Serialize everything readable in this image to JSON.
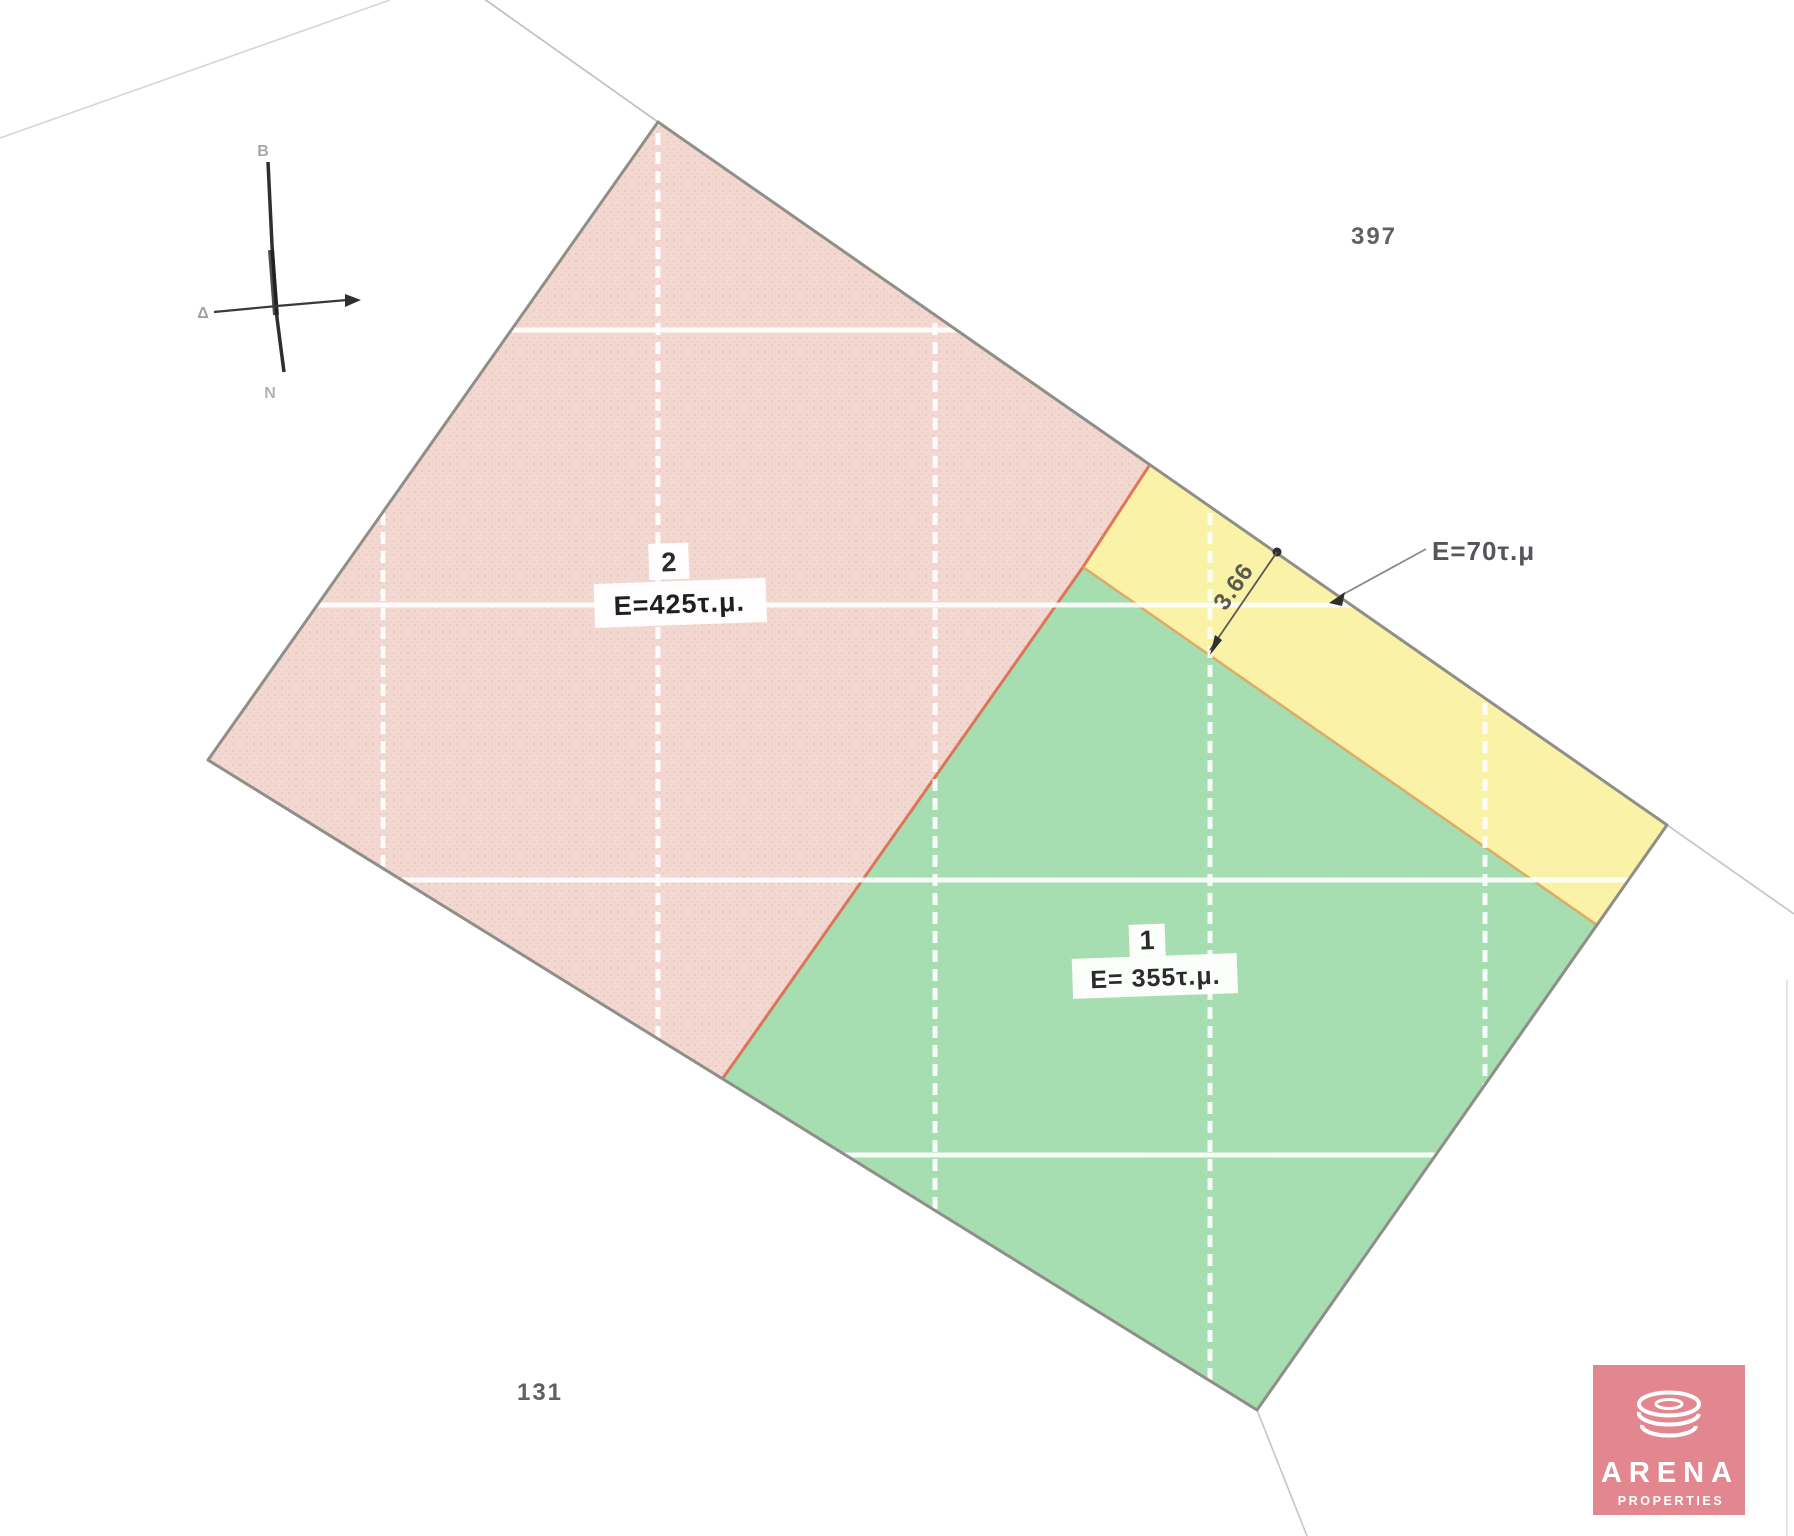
{
  "plan": {
    "plot2": {
      "number": "2",
      "area_label": "E=425τ.μ."
    },
    "plot1": {
      "number": "1",
      "area_label": "E= 355τ.μ."
    },
    "strip": {
      "area_label": "E=70τ.μ",
      "width_label": "3.66"
    },
    "adjacent_parcels": {
      "north_east": "397",
      "south_west": "131"
    }
  },
  "compass": {
    "north_label": "B",
    "west_label": "Δ",
    "south_label": "N"
  },
  "logo": {
    "brand": "ARENA",
    "tagline": "PROPERTIES"
  },
  "colors": {
    "plot2_pink": "#f3d8d1",
    "plot2_dot": "#d9a89e",
    "plot1_green": "#a7deb1",
    "strip_yellow": "#faf3a7",
    "boundary_gray": "#8f8e88",
    "division_red": "#dd6a50",
    "division_tan": "#e0a45e",
    "grid_white": "#ffffff",
    "logo_pink": "#e2868f"
  }
}
